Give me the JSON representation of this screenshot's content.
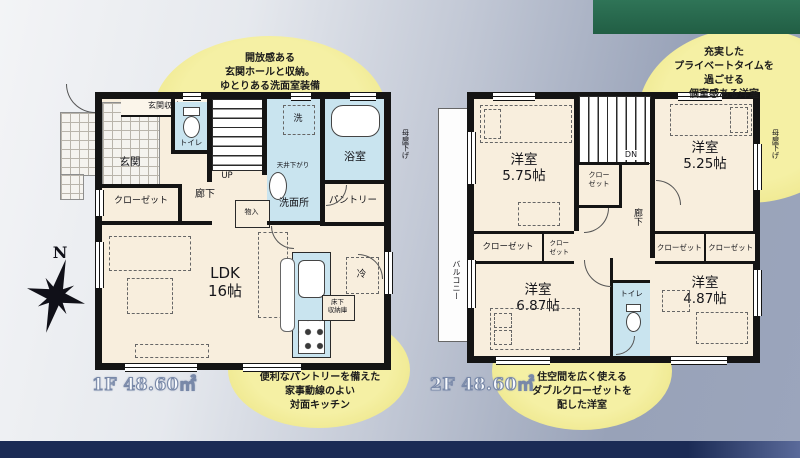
{
  "theme": {
    "accent_green": "#2a6b4f",
    "accent_navy": "#1d2c55",
    "bubble_yellow": "#efe88d",
    "wall_black": "#141414",
    "room_cream": "#f8eedd",
    "wet_blue": "#c9e4ef"
  },
  "compass": {
    "north": "N"
  },
  "callouts": {
    "top_left": "開放感ある\n玄関ホールと収納。\nゆとりある洗面室装備",
    "top_right": "充実した\nプライベートタイムを\n過ごせる\n個室感ある洋室",
    "bottom_left": "便利なパントリーを備えた\n家事動線のよい\n対面キッチン",
    "bottom_right": "住空間を広く使える\nダブルクローゼットを\n配した洋室"
  },
  "floor1": {
    "area_label": "1F 48.60㎡",
    "labels": {
      "genkan_storage": "玄関収納",
      "genkan": "玄関",
      "toilet": "トイレ",
      "up": "UP",
      "wash": "洗",
      "ceiling_drop": "天井下がり",
      "washroom": "洗面所",
      "bathroom": "浴室",
      "pantry": "パントリー",
      "hallway": "廊下",
      "closet": "クローゼット",
      "storage": "物入",
      "ldk": "LDK\n16帖",
      "fridge": "冷",
      "underfloor_storage": "床下\n収納庫",
      "moya_sage": "母屋下げ"
    }
  },
  "floor2": {
    "area_label": "2F 48.60㎡",
    "labels": {
      "balcony": "バルコニー",
      "room_575": "洋室\n5.75帖",
      "room_525": "洋室\n5.25帖",
      "room_687": "洋室\n6.87帖",
      "room_487": "洋室\n4.87帖",
      "dn": "DN",
      "closet_stair": "クロー\nゼット",
      "hallway": "廊下",
      "closet_687_a": "クローゼット",
      "closet_687_b": "クロー\nゼット",
      "closet_487_a": "クローゼット",
      "closet_487_b": "クローゼット",
      "toilet": "トイレ",
      "moya_sage": "母屋下げ"
    }
  }
}
